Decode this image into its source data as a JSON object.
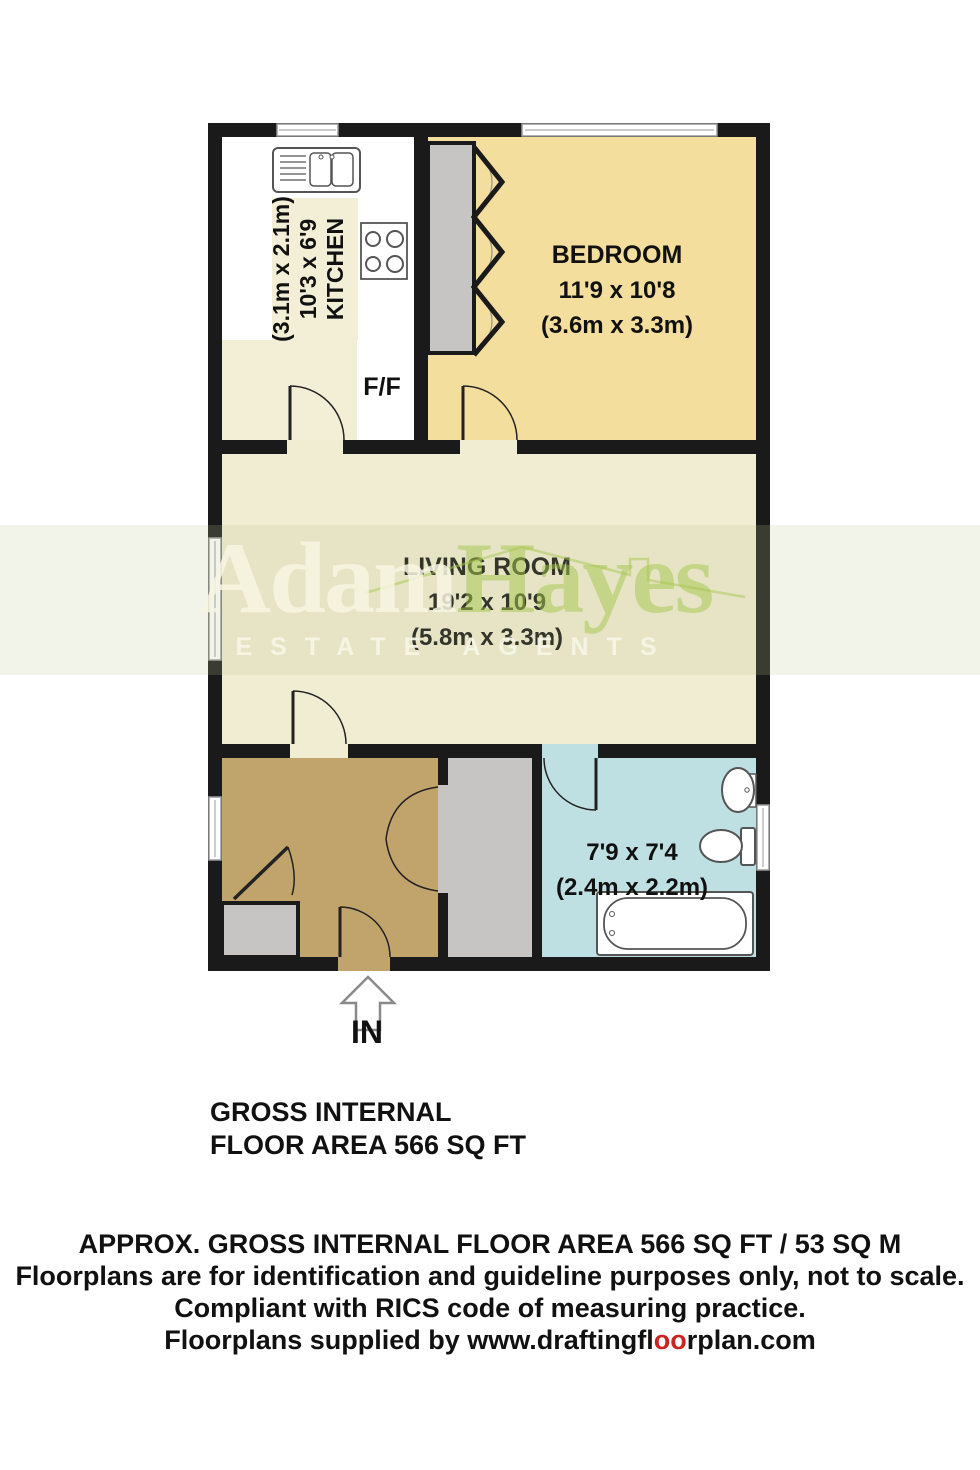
{
  "watermark": {
    "brand_first": "Adam",
    "brand_second": "Hayes",
    "tagline": "ESTATE AGENTS"
  },
  "rooms": {
    "kitchen": {
      "label": "KITCHEN",
      "dims_ft": "10'3 x 6'9",
      "dims_m": "(3.1m x 2.1m)"
    },
    "bedroom": {
      "label": "BEDROOM",
      "dims_ft": "11'9 x 10'8",
      "dims_m": "(3.6m x 3.3m)"
    },
    "living_room": {
      "label": "LIVING ROOM",
      "dims_ft": "19'2 x 10'9",
      "dims_m": "(5.8m x 3.3m)"
    },
    "bathroom": {
      "dims_ft": "7'9 x 7'4",
      "dims_m": "(2.4m x 2.2m)"
    }
  },
  "labels": {
    "fridge_freezer": "F/F",
    "entrance": "IN"
  },
  "area_note": {
    "line1": "GROSS INTERNAL",
    "line2": "FLOOR AREA 566 SQ FT"
  },
  "footer": {
    "line1": "APPROX. GROSS INTERNAL FLOOR AREA 566 SQ FT / 53 SQ M",
    "line2": "Floorplans are for identification and guideline purposes only, not to scale.",
    "line3": "Compliant with RICS code of measuring practice.",
    "line4_prefix": "Floorplans supplied by www.draftingfl",
    "line4_highlight": "oo",
    "line4_suffix": "rplan.com"
  },
  "colors": {
    "wall": "#1a1a1a",
    "bedroom": "#f4de9e",
    "living": "#f1edd3",
    "kitchen_counter": "#f3efd6",
    "hallway": "#c1a36c",
    "storage": "#c6c5c3",
    "bathroom": "#bfe0e2",
    "window_frame": "#999999",
    "fixture_outline": "#555555",
    "accent_red": "#cc2222"
  }
}
